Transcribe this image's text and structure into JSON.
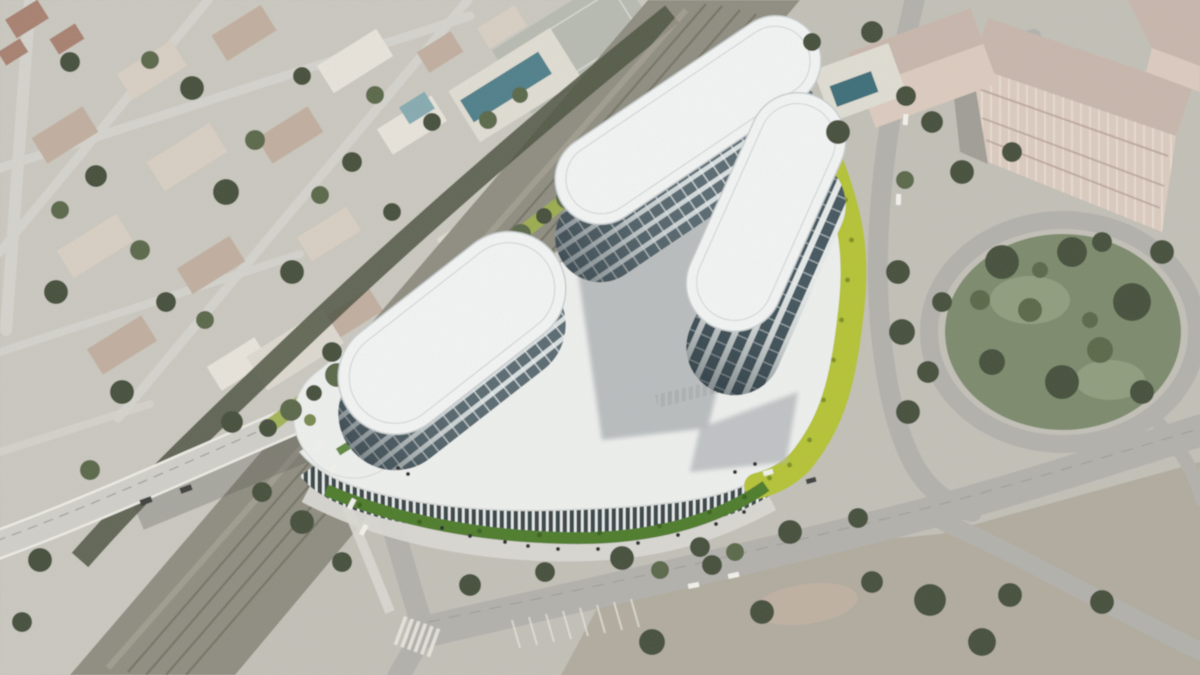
{
  "meta": {
    "title": "Aerial photograph with architectural rendering of a three-tower office complex on a white podium",
    "description": "Oblique aerial city photo: residential blocks and trees upper-left, a diagonal railway corridor crossed by a road bridge, a rendered office complex of three rounded pill-shaped glass towers rising from a curved white podium with colonnade base and bright chartreuse landscaping, a circular tree-filled park ring road at right, pink apartment buildings top-right, boulevard and junctions at bottom."
  },
  "colors": {
    "ground": "#c2c0b7",
    "groundLight": "#cac8bf",
    "road": "#b2b1ac",
    "roadLight": "#d4d3cd",
    "sidewalk": "#d9d8d2",
    "bridgeRoad": "#d0cfc9",
    "bridgeEdge": "#ecebe4",
    "underBridgeShadow": "#50504a",
    "laneLine": "#9b9a92",
    "crosswalk": "#e9e7e0",
    "railCorridor": "#8f8d80",
    "railTrack": "#6f6e60",
    "gravel": "#a6a396",
    "scrub": "#4d5441",
    "treeDark": "#44503a",
    "treeMid": "#5a6848",
    "treeLight": "#79894f",
    "grassPark": "#7b8a6c",
    "grassLight": "#909d7e",
    "dirt": "#b0ab9c",
    "dirtPink": "#c2b2a2",
    "roofTan": "#c1ae9f",
    "roofLight": "#d9cfc3",
    "roofWhite": "#e8e4db",
    "roofRed": "#a8806f",
    "paleBuilding": "#ddd9cf",
    "courtPaved": "#b8bbb2",
    "courtLine": "#d6d9d0",
    "poolDeck": "#e0ddd3",
    "poolTeal": "#4f7f8a",
    "poolDark": "#3e6e79",
    "poolLight": "#86abb1",
    "pinkRoof": "#c8b6ac",
    "pinkFace": "#dccbbf",
    "pinkShade": "#b49c90",
    "pinkWindow": "#efe8df",
    "buildingShadow": "#77766c",
    "podiumRoof": "#eef0ee",
    "podiumEdge": "#d8dbd9",
    "podiumShadow": "#b4b8ba",
    "towerRoof": "#f3f5f4",
    "towerRoofEdge": "#c9ced0",
    "towerInnerLine": "#cdd2d3",
    "glassDark": "#5a6b72",
    "glassBand": "#d9e0e1",
    "glassDark2": "#44565e",
    "glassBand2": "#e6ebea",
    "mullion": "#eff2f2",
    "glassShade": "#1f2c33",
    "pilotisDark": "#394547",
    "pilotisLight": "#e9ebe9",
    "chartreuse": "#b5c335",
    "chartreuseDark": "#7d9321",
    "chartreuseSoft": "#9db04a",
    "bushGreen": "#4e7c2c",
    "bushDark": "#39621f",
    "carWhite": "#f2f1ec",
    "carDark": "#3c3f3e",
    "people": "#2b2e2d"
  }
}
